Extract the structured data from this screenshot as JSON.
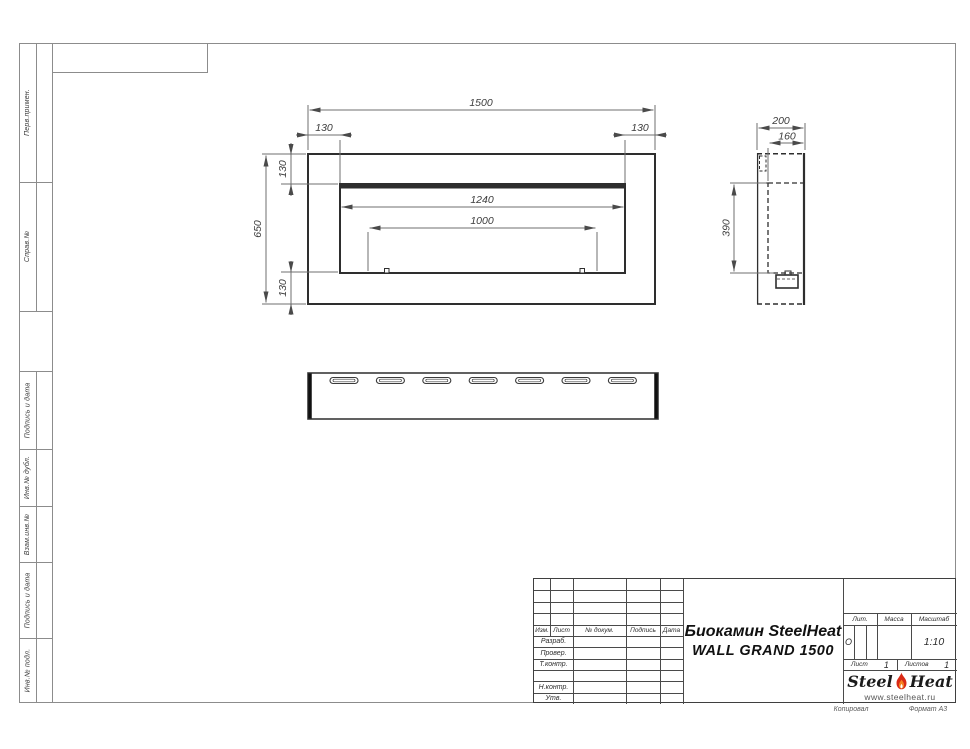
{
  "margin": {
    "labels": {
      "perv_primen": "Перв.примен.",
      "sprav_no": "Справ.№",
      "podpis_i_data_upper": "Подпись и дата",
      "inv_no_dubl": "Инв.№ дубл.",
      "vzam_inv_no": "Взам.инв.№",
      "podpis_i_data_lower": "Подпись и дата",
      "inv_no_podl": "Инв.№ подл."
    }
  },
  "views": {
    "front": {
      "dims": {
        "width": "1500",
        "inset_left": "130",
        "inset_right": "130",
        "height": "650",
        "inset_top": "130",
        "inset_bottom": "130",
        "opening_width": "1240",
        "burner_width": "1000"
      }
    },
    "side": {
      "dims": {
        "depth": "200",
        "inner_depth": "160",
        "opening_height": "390"
      }
    }
  },
  "title_block": {
    "header": {
      "izm": "Изм.",
      "list": "Лист",
      "doc": "№ докум.",
      "podpis": "Подпись",
      "data": "Дата"
    },
    "rows": {
      "razrab": "Разраб.",
      "prover": "Провер.",
      "tkontr": "Т.контр.",
      "nkontr": "Н.контр.",
      "utv": "Утв."
    },
    "title_line1": "Биокамин SteelHeat",
    "title_line2": "WALL GRAND 1500",
    "lit_label": "Лит.",
    "lit_value": "О",
    "massa_label": "Масса",
    "masshtab_label": "Масштаб",
    "masshtab_value": "1:10",
    "list_label": "Лист",
    "list_value": "1",
    "listov_label": "Листов",
    "listov_value": "1"
  },
  "logo": {
    "name_part1": "Steel",
    "name_part2": "Heat",
    "website": "www.steelheat.ru"
  },
  "footer": {
    "left": "Копировал",
    "right": "Формат А3"
  },
  "colors": {
    "line_dark": "#2e2e2e",
    "line_dim": "#6f6f6f",
    "flame_outer": "#d92a15",
    "flame_inner": "#f58220"
  }
}
